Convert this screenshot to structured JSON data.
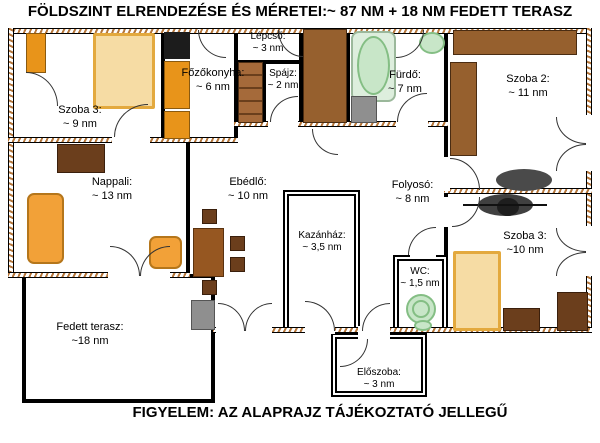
{
  "title": "FÖLDSZINT ELRENDEZÉSE ÉS MÉRETEI:~ 87 NM + 18 NM FEDETT TERASZ",
  "footer": "FIGYELEM: AZ ALAPRAJZ TÁJÉKOZTATÓ JELLEGŰ",
  "rooms": [
    {
      "id": "szoba3-felso",
      "name": "Szoba 3:",
      "area": "~ 9 nm"
    },
    {
      "id": "fozokonyha",
      "name": "Főzőkonyha:",
      "area": "~ 6 nm"
    },
    {
      "id": "lepcso",
      "name": "Lépcső:",
      "area": "~ 3 nm"
    },
    {
      "id": "spajz",
      "name": "Spájz:",
      "area": "~ 2 nm"
    },
    {
      "id": "furdo",
      "name": "Fürdő:",
      "area": "~ 7 nm"
    },
    {
      "id": "szoba2",
      "name": "Szoba 2:",
      "area": "~ 11 nm"
    },
    {
      "id": "nappali",
      "name": "Nappali:",
      "area": "~ 13 nm"
    },
    {
      "id": "ebedlo",
      "name": "Ebédlő:",
      "area": "~ 10 nm"
    },
    {
      "id": "folyoso",
      "name": "Folyosó:",
      "area": "~ 8 nm"
    },
    {
      "id": "kazanhaz",
      "name": "Kazánház:",
      "area": "~ 3,5 nm"
    },
    {
      "id": "wc",
      "name": "WC:",
      "area": "~ 1,5 nm"
    },
    {
      "id": "szoba3-also",
      "name": "Szoba 3:",
      "area": "~10 nm"
    },
    {
      "id": "fedett-terasz",
      "name": "Fedett terasz:",
      "area": "~18 nm"
    },
    {
      "id": "eloszoba",
      "name": "Előszoba:",
      "area": "~ 3 nm"
    }
  ],
  "colors": {
    "wall_hatch": "#b5763a",
    "furniture_orange": "#E8941A",
    "furniture_brown": "#96602e",
    "furniture_dark_brown": "#6B3E1C",
    "bed_tan": "#F6DCA4",
    "fixture_green": "#C8E6C8",
    "appliance_gray": "#8F8F8F"
  }
}
